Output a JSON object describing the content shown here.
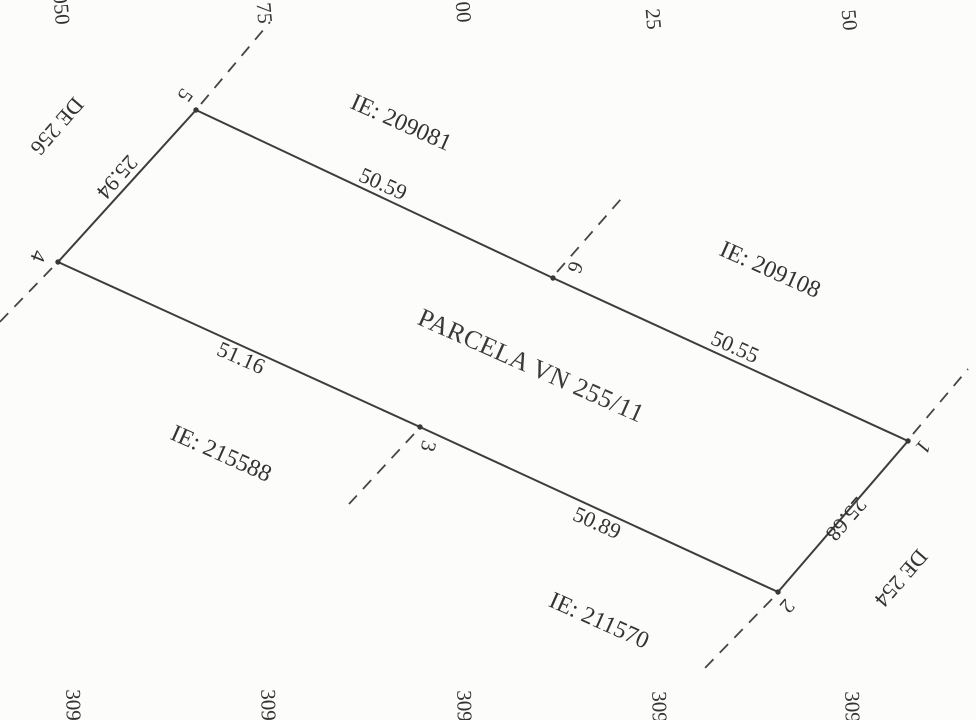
{
  "map": {
    "title": "PARCELA VN 255/11",
    "colors": {
      "background": "#fcfcfa",
      "line": "#3d3d3d",
      "text": "#333333"
    },
    "outline": [
      "4",
      "5",
      "6",
      "1",
      "2",
      "3"
    ],
    "points": [
      {
        "id": "1",
        "x": 908,
        "y": 441,
        "ext": {
          "x1": 913,
          "y1": 434,
          "x2": 968,
          "y2": 369
        }
      },
      {
        "id": "2",
        "x": 778,
        "y": 592,
        "ext": {
          "x1": 772,
          "y1": 599,
          "x2": 703,
          "y2": 670
        }
      },
      {
        "id": "3",
        "x": 420,
        "y": 427,
        "ext": {
          "x1": 414,
          "y1": 434,
          "x2": 349,
          "y2": 504
        }
      },
      {
        "id": "4",
        "x": 58,
        "y": 262,
        "ext": {
          "x1": 52,
          "y1": 268,
          "x2": -8,
          "y2": 330
        }
      },
      {
        "id": "5",
        "x": 196,
        "y": 110,
        "ext": {
          "x1": 201,
          "y1": 104,
          "x2": 270,
          "y2": 22
        }
      },
      {
        "id": "6",
        "x": 553,
        "y": 278,
        "ext": {
          "x1": 557,
          "y1": 272,
          "x2": 621,
          "y2": 199
        }
      }
    ],
    "edges": [
      {
        "from": "4",
        "to": "5",
        "length_m": 25.94
      },
      {
        "from": "5",
        "to": "6",
        "length_m": 50.59
      },
      {
        "from": "6",
        "to": "1",
        "length_m": 50.55
      },
      {
        "from": "1",
        "to": "2",
        "length_m": 25.68
      },
      {
        "from": "2",
        "to": "3",
        "length_m": 50.89
      },
      {
        "from": "3",
        "to": "4",
        "length_m": 51.16
      }
    ],
    "neighbor_parcels": [
      "IE: 209081",
      "IE: 209108",
      "IE: 215588",
      "IE: 211570"
    ],
    "road_refs": [
      "DE 256",
      "DE 254"
    ],
    "grid": {
      "top_labels": [
        "050",
        "75",
        "00",
        "25",
        "50"
      ],
      "bottom_labels": [
        "309",
        "309",
        "309",
        "309",
        "309"
      ]
    }
  },
  "annotations": [
    {
      "name": "neighbor-label-209081",
      "text": "IE: 209081",
      "x": 401,
      "y": 123,
      "rot": 24,
      "size": 24
    },
    {
      "name": "neighbor-label-209108",
      "text": "IE: 209108",
      "x": 770,
      "y": 270,
      "rot": 24,
      "size": 24
    },
    {
      "name": "neighbor-label-215588",
      "text": "IE: 215588",
      "x": 221,
      "y": 454,
      "rot": 24,
      "size": 24
    },
    {
      "name": "neighbor-label-211570",
      "text": "IE: 211570",
      "x": 599,
      "y": 621,
      "rot": 24,
      "size": 24
    },
    {
      "name": "edge-length-5-6",
      "text": "50.59",
      "x": 383,
      "y": 184,
      "rot": 24,
      "size": 22
    },
    {
      "name": "edge-length-6-1",
      "text": "50.55",
      "x": 735,
      "y": 347,
      "rot": 24,
      "size": 22
    },
    {
      "name": "edge-length-3-4",
      "text": "51.16",
      "x": 241,
      "y": 358,
      "rot": 24,
      "size": 22
    },
    {
      "name": "edge-length-2-3",
      "text": "50.89",
      "x": 597,
      "y": 523,
      "rot": 24,
      "size": 22
    },
    {
      "name": "edge-length-4-5",
      "text": "25.94",
      "x": 117,
      "y": 177,
      "rot": 131,
      "size": 22
    },
    {
      "name": "edge-length-1-2",
      "text": "25.68",
      "x": 846,
      "y": 519,
      "rot": 131,
      "size": 22
    },
    {
      "name": "road-label-de-256",
      "text": "DE 256",
      "x": 57,
      "y": 126,
      "rot": 131,
      "size": 22
    },
    {
      "name": "road-label-de-254",
      "text": "DE 254",
      "x": 901,
      "y": 578,
      "rot": 131,
      "size": 22
    },
    {
      "name": "vertex-label-5",
      "text": "5",
      "x": 185,
      "y": 95,
      "rot": 125,
      "size": 21
    },
    {
      "name": "vertex-label-4",
      "text": "4",
      "x": 38,
      "y": 256,
      "rot": 112,
      "size": 21
    },
    {
      "name": "vertex-label-6",
      "text": "6",
      "x": 575,
      "y": 267,
      "rot": 112,
      "size": 21
    },
    {
      "name": "vertex-label-3",
      "text": "3",
      "x": 428,
      "y": 446,
      "rot": 104,
      "size": 21
    },
    {
      "name": "vertex-label-1",
      "text": "1",
      "x": 923,
      "y": 447,
      "rot": 130,
      "size": 21
    },
    {
      "name": "vertex-label-2",
      "text": "2",
      "x": 787,
      "y": 606,
      "rot": 130,
      "size": 21
    },
    {
      "name": "grid-label-top-1",
      "text": "050",
      "x": 61,
      "y": 9,
      "rot": 85,
      "size": 21
    },
    {
      "name": "grid-label-top-2",
      "text": "75",
      "x": 264,
      "y": 13,
      "rot": 85,
      "size": 21
    },
    {
      "name": "grid-label-top-3",
      "text": "00",
      "x": 463,
      "y": 12,
      "rot": 85,
      "size": 21
    },
    {
      "name": "grid-label-top-4",
      "text": "25",
      "x": 653,
      "y": 19,
      "rot": 85,
      "size": 21
    },
    {
      "name": "grid-label-top-5",
      "text": "50",
      "x": 849,
      "y": 20,
      "rot": 85,
      "size": 21
    },
    {
      "name": "grid-label-bottom-1",
      "text": "309",
      "x": 73,
      "y": 705,
      "rot": 89,
      "size": 21
    },
    {
      "name": "grid-label-bottom-2",
      "text": "309",
      "x": 268,
      "y": 705,
      "rot": 89,
      "size": 21
    },
    {
      "name": "grid-label-bottom-3",
      "text": "309",
      "x": 464,
      "y": 706,
      "rot": 89,
      "size": 21
    },
    {
      "name": "grid-label-bottom-4",
      "text": "309",
      "x": 659,
      "y": 707,
      "rot": 89,
      "size": 21
    },
    {
      "name": "grid-label-bottom-5",
      "text": "309",
      "x": 852,
      "y": 707,
      "rot": 89,
      "size": 21
    }
  ]
}
